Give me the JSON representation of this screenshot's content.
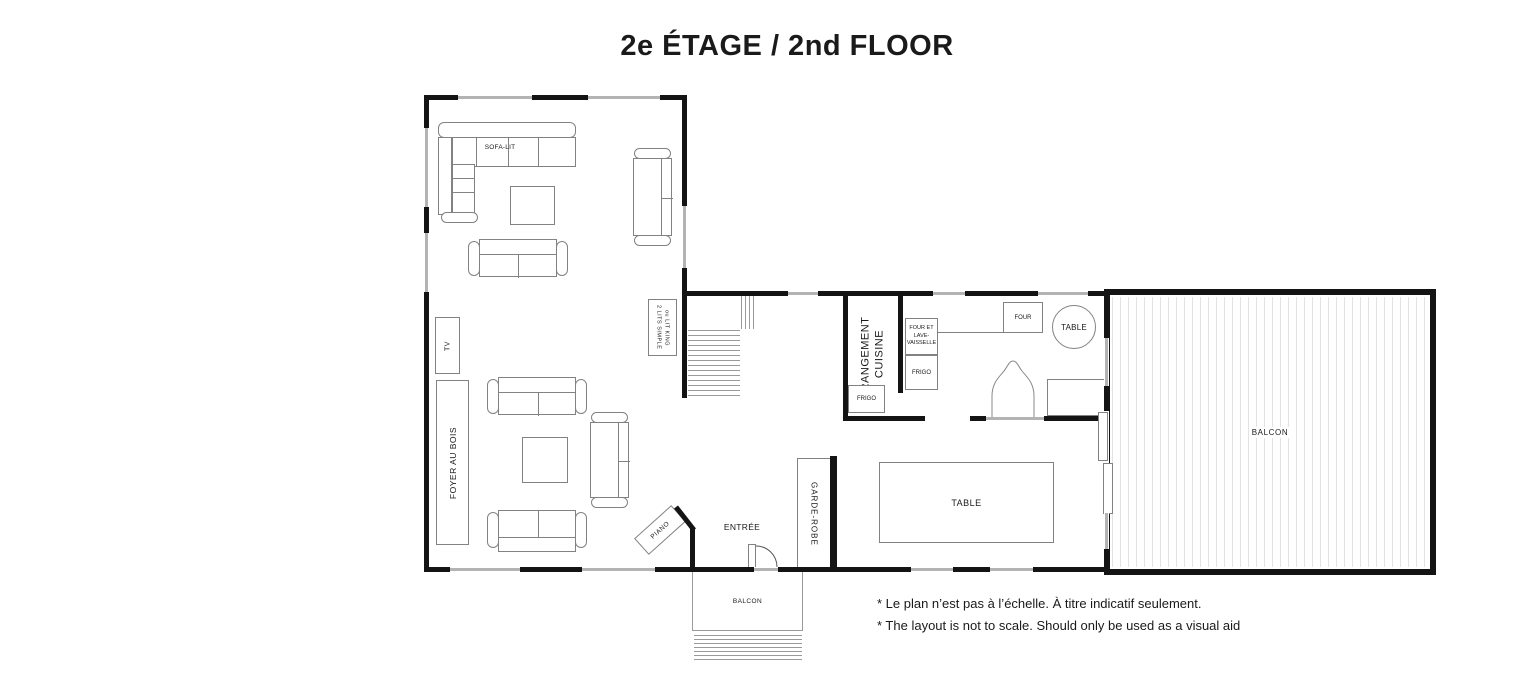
{
  "title": "2e ÉTAGE / 2nd FLOOR",
  "living_upper": {
    "sofa_bed": "SOFA-LIT"
  },
  "bedroom_note": {
    "line1": "2  LITS SIMPLE",
    "line2": "ou LIT KING"
  },
  "living_lower": {
    "tv": "TV",
    "fireplace": "FOYER AU BOIS",
    "piano": "PIANO"
  },
  "entry": {
    "label": "ENTRÉE",
    "closet": "GARDE-ROBE"
  },
  "kitchen": {
    "storage_line1": "RANGEMENT",
    "storage_line2": "CUISINE",
    "fridge_small": "FRIGO",
    "appliance_line1": "FOUR ET",
    "appliance_line2": "LAVE-",
    "appliance_line3": "VAISSELLE",
    "fridge": "FRIGO",
    "oven": "FOUR",
    "round_table": "TABLE"
  },
  "dining": {
    "table": "TABLE"
  },
  "balcony_right": {
    "label": "BALCON"
  },
  "balcony_bottom": {
    "label": "BALCON"
  },
  "footnotes": {
    "fr": "* Le plan n’est pas à l’échelle. À titre indicatif seulement.",
    "en": "* The layout is not to scale. Should only be used as a visual aid"
  }
}
